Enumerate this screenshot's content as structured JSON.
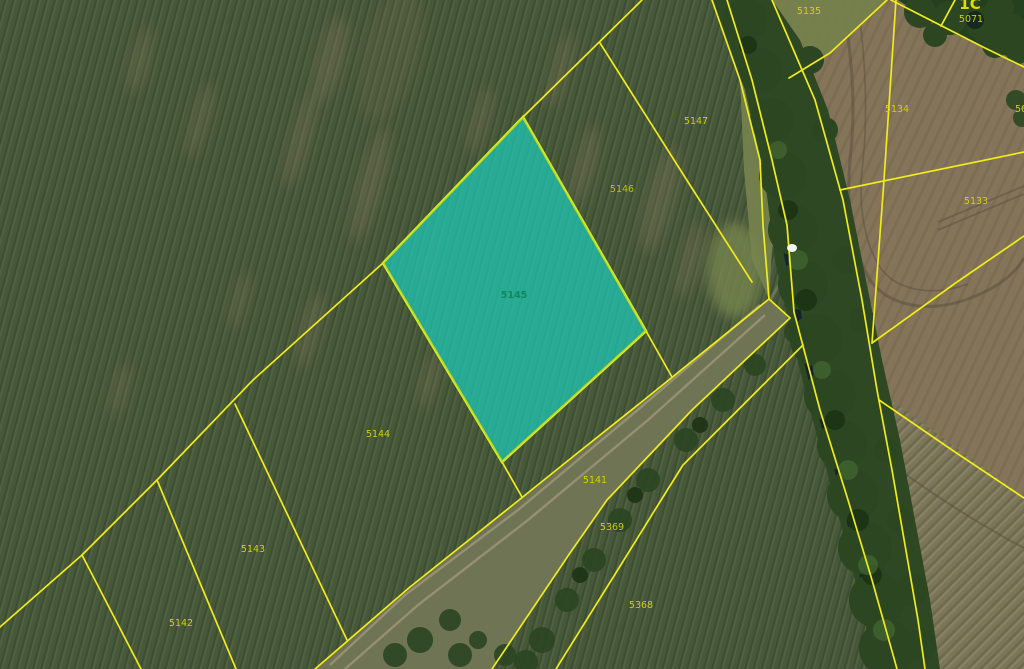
{
  "map": {
    "description": "cadastral parcel map over aerial orthophoto",
    "boundary_color": "#f0eb1a",
    "label_color": "#d6d800",
    "highlight": {
      "parcel_label": "5145",
      "fill_color": "#1bcdbb",
      "fill_opacity": "0.82",
      "stroke_color": "#d3ee1e",
      "label_color": "#0e8a58"
    },
    "parcel_labels": {
      "p5147": "5147",
      "p5146": "5146",
      "p5144": "5144",
      "p5143": "5143",
      "p5142": "5142",
      "p5141": "5141",
      "p5369": "5369",
      "p5368": "5368",
      "p5135": "5135",
      "p5134": "5134",
      "p5133": "5133",
      "p5071": "5071",
      "p50_partial": "50",
      "area_code_partial": "1C"
    }
  }
}
